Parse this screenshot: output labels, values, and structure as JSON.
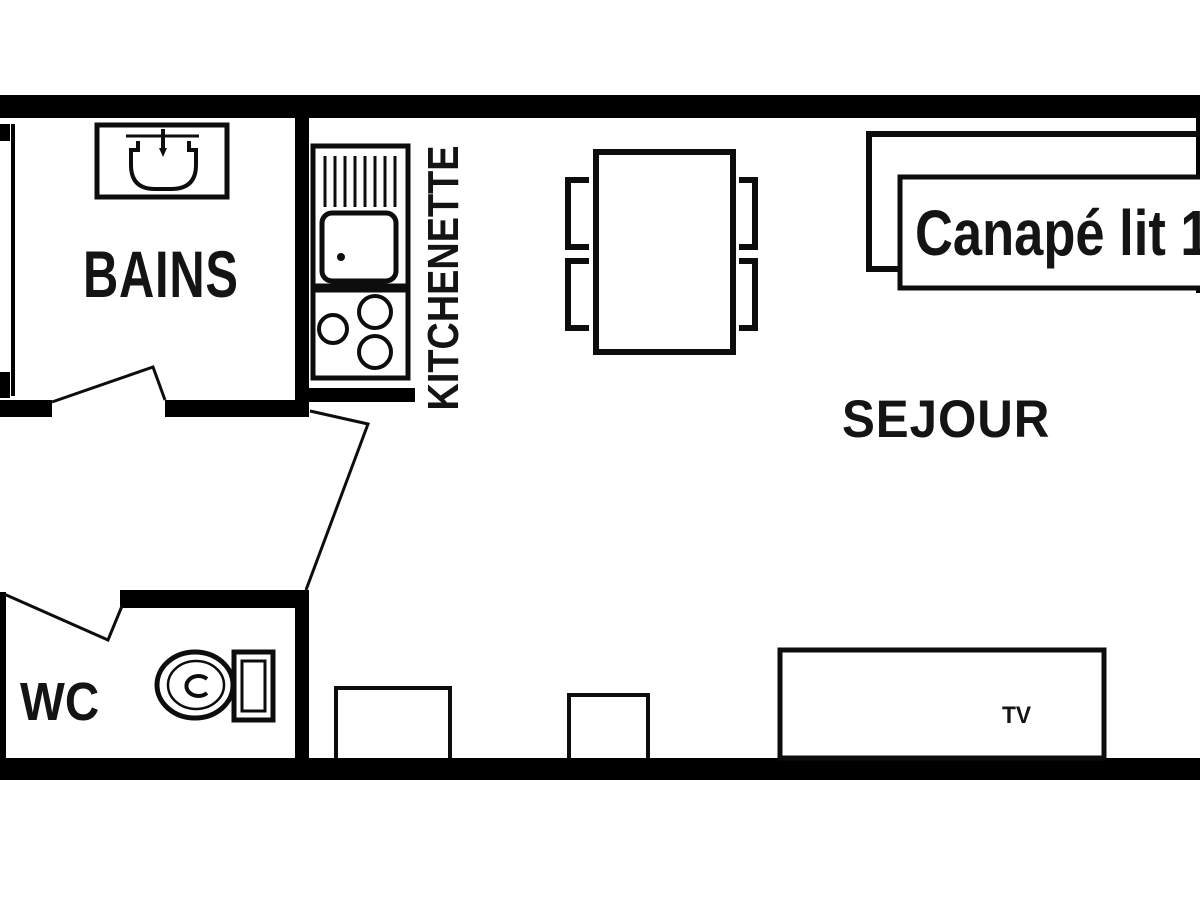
{
  "document": {
    "type": "apartment-floor-plan",
    "language": "fr"
  },
  "colors": {
    "wall": "#000000",
    "line": "#0d0d0d",
    "background": "#ffffff"
  },
  "rooms": {
    "bathroom": {
      "label": "BAINS"
    },
    "kitchenette": {
      "label": "KITCHENETTE"
    },
    "living_room": {
      "label": "SEJOUR"
    },
    "wc": {
      "label": "WC"
    }
  },
  "furniture": {
    "sofa_bed": {
      "label": "Canapé lit 1"
    },
    "tv": {
      "label": "TV"
    }
  },
  "icons": [
    "washbasin-icon",
    "kitchen-sink-icon",
    "drainer-icon",
    "cooktop-icon",
    "dining-table-icon",
    "chair-icon",
    "toilet-icon",
    "door-swing-icon",
    "sofa-bed-icon",
    "tv-cabinet-icon",
    "storage-unit-icon"
  ]
}
